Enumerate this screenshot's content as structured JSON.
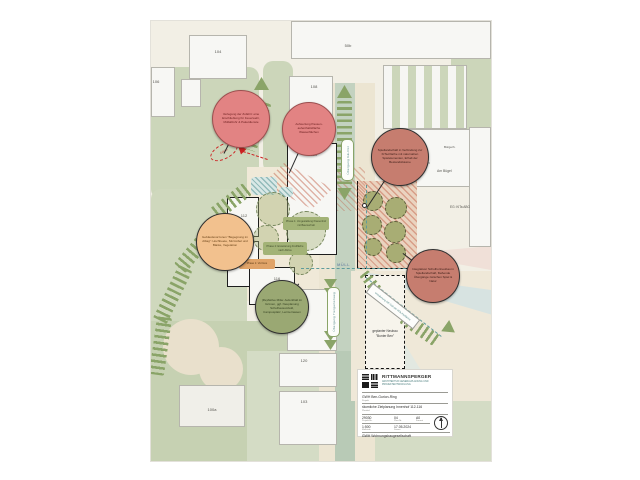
{
  "plan": {
    "bubbles": [
      {
        "text": "Verlegung der Zufahrt: eine Erschließung für Feuerwehr, Müllabfuhr & Paketdienste",
        "fill": "#e28383",
        "border": "#9c4f4f"
      },
      {
        "text": "Aufwertung Pausen- aufenthaltsfläche Wasserflächen",
        "fill": "#e28383",
        "border": "#9c4f4f"
      },
      {
        "text": "Spiellandschaft in Verbindung zur KiTa-Fläche mit naturnahen Spielelementen, Erhalt der Bestandsbäume",
        "fill": "#c67d6f",
        "border": "#2f2f2f"
      },
      {
        "text": "Integrativer Schulhortneubau in Spiellandschaft, fließende Übergänge zwischen Spiel & Natur",
        "fill": "#c67d6f",
        "border": "#2f2f2f"
      },
      {
        "text": "Gebäudevorzonen \"Begegnung im Alltag\": Hochbeete, Sitzmöbel und Bänke, Vegetation",
        "fill": "#f2c18e",
        "border": "#2f2f2f"
      },
      {
        "text": "(Re)Aktive Mitte: Aufenthalt im Grünen, ggf. Neuplanung Schulhausumfeld, Campusplatz, Lernterrassen",
        "fill": "#9aa873",
        "border": "#2f2f2f"
      }
    ],
    "phase_boxes": [
      {
        "text": "Phase 1: Umgestaltung Pausenhof mit Baumerhalt",
        "fill": "#a3b377"
      },
      {
        "text": "Phase 2: Erweiterung Freifläche nach Abriss",
        "fill": "#a3b377"
      },
      {
        "text": "Phase 1: Vorzone",
        "fill": "#e0a368"
      }
    ],
    "labels": {
      "muell": "MÜLL",
      "uebergang_ost": "Übergang GE-Ost",
      "uebergang_tiergarten": "Übergang Tiergartenweg",
      "umzaeunung": "Umzäunung GE-Süd der KiTa-Freifläche",
      "neubau": "geplanter Neubau \"Bunter Ben\"",
      "zufahrt": "Zufahrt",
      "zentrum": "Zentrum",
      "am_buegel": "Am Bügel",
      "buergerhaus": "Bürgerh.",
      "kita": "EG: KiTa ABG"
    },
    "buildings": {
      "b104": "104",
      "b106": "106",
      "b50b": "50b",
      "b108": "108",
      "b110": "110",
      "b112": "112",
      "b114": "114",
      "b116": "116",
      "b118": "118",
      "b120": "120",
      "b103": "103",
      "b100a": "100a"
    }
  },
  "titleblock": {
    "firm": "RITTMANNSPERGER",
    "firm_sub": "ARCHITEKTUR GENERALPLANUNG UND PROJEKTENTWICKLUNG",
    "project": "GWH Ben-Gurion-Ring",
    "project_label": "Projekt",
    "plan_title": "räumliche Zielplanung Innenhof 112-116",
    "plan_title_label": "Plantitel",
    "project_no": "29030",
    "project_no_label": "Projekt-Nr.",
    "plan_no": "04",
    "plan_no_label": "Plan-Nr.",
    "format": "A0",
    "format_label": "Format",
    "scale": "1:500",
    "scale_label": "Maßstab",
    "date": "17.05.2024",
    "date_label": "Datum",
    "client": "GWH Wohnungsbaugesellschaft",
    "client_label": "Bauherr"
  },
  "colors": {
    "chevron_green": "#8aa468",
    "bubble_red": "#e28383",
    "bubble_dark_red": "#c67d6f",
    "bubble_orange": "#f2c18e",
    "bubble_olive": "#9aa873",
    "accent_red": "#cc2222",
    "teal": "#5f9b9b",
    "lawn": "#ccd6ba"
  }
}
